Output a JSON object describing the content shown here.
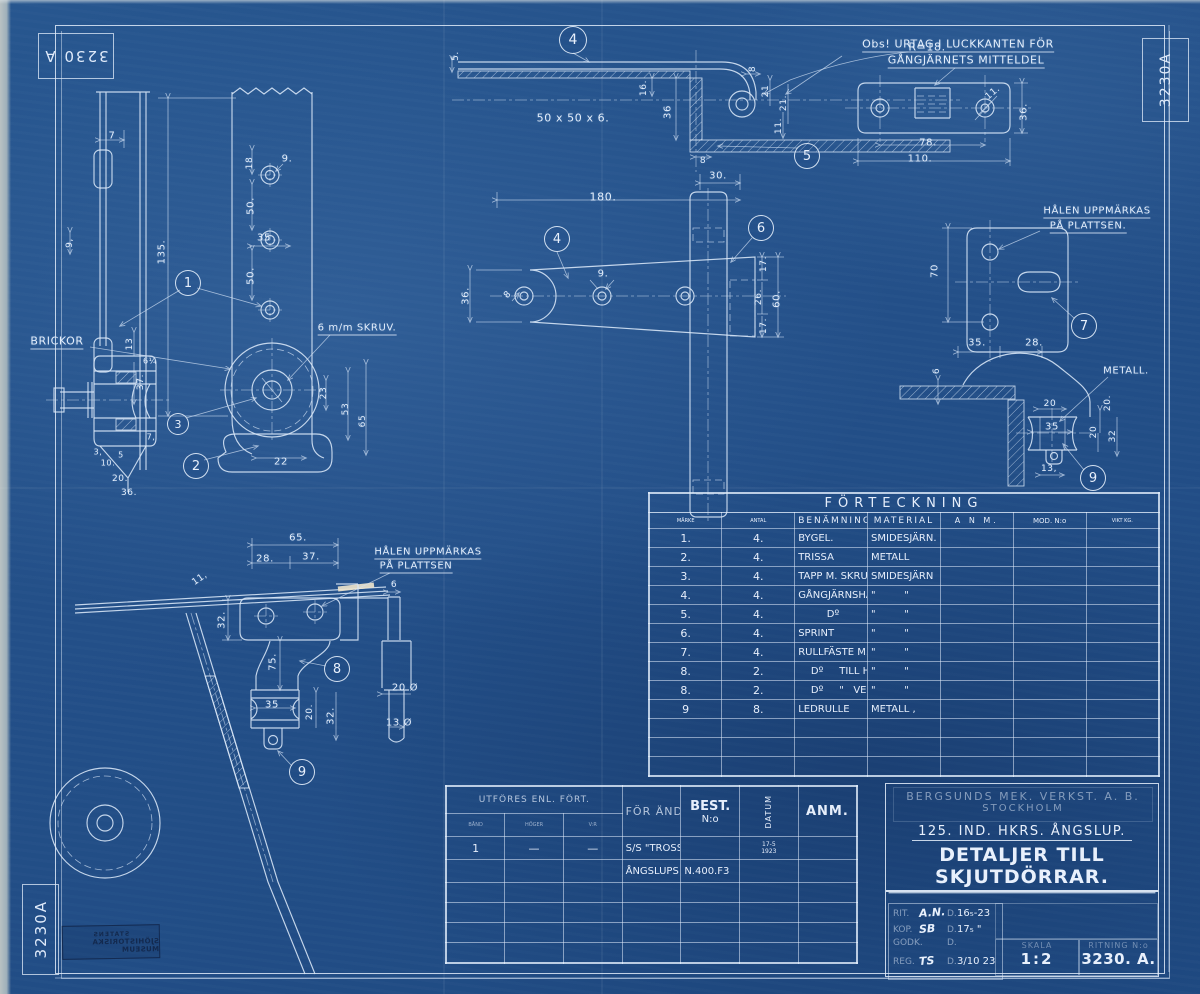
{
  "colors": {
    "background": "#234f88",
    "linework": "#dce9f8",
    "cream_highlight": "#f0e6cc",
    "museum_stamp": "#13294e"
  },
  "stamps": {
    "top_left": "3230 A",
    "top_right": "3230A",
    "bottom_left": "3230A",
    "museum_line1": "STATENS",
    "museum_line2": "SJÖHISTORISKA MUSEUM"
  },
  "parts_table": {
    "title": "FÖRTECKNING",
    "columns": [
      "MÄRKE",
      "ANTAL",
      "BENÄMNING",
      "MATERIAL",
      "A N M.",
      "MOD. N:o",
      "VIKT KG."
    ],
    "rows": [
      [
        "1.",
        "4.",
        "BYGEL.",
        "SMIDESJÄRN.",
        "",
        "",
        ""
      ],
      [
        "2.",
        "4.",
        "TRISSA",
        "METALL",
        "",
        "",
        ""
      ],
      [
        "3.",
        "4.",
        "TAPP M. SKRUV Ö. BRICKOR",
        "SMIDESJÄRN",
        "",
        "",
        ""
      ],
      [
        "4.",
        "4.",
        "GÅNGJÄRNSHALVA",
        "\"         \"",
        "",
        "",
        ""
      ],
      [
        "5.",
        "4.",
        "         Dº",
        "\"         \"",
        "",
        "",
        ""
      ],
      [
        "6.",
        "4.",
        "SPRINT",
        "\"         \"",
        "",
        "",
        ""
      ],
      [
        "7.",
        "4.",
        "RULLFÄSTE M. BRICKA Ö. SPRINT",
        "\"         \"",
        "",
        "",
        ""
      ],
      [
        "8.",
        "2.",
        "    Dº     TILL HÖGER",
        "\"         \"",
        "",
        "",
        ""
      ],
      [
        "8.",
        "2.",
        "    Dº     \"   VENSTER",
        "\"         \"",
        "",
        "",
        ""
      ],
      [
        "9",
        "8.",
        "LEDRULLE",
        "METALL ,",
        "",
        "",
        ""
      ]
    ],
    "empty_rows": 3
  },
  "order_table": {
    "header_main": "UTFÖRES ENL. FÖRT.",
    "sub_columns": [
      "BÅND",
      "HÖGER",
      "V:R"
    ],
    "col_purpose": "FÖR ÄNDAMÅL",
    "col_best_line1": "BEST.",
    "col_best_line2": "N:o",
    "col_datum": "DATUM",
    "col_anm": "ANM.",
    "rows": [
      [
        "1",
        "—",
        "—",
        "S/S \"TROSSÖ\" KARLSKRONA",
        "",
        "17-5|1923",
        ""
      ],
      [
        "",
        "",
        "",
        "ÅNGSLUPS A.B.",
        "N.400.F3",
        "",
        ""
      ]
    ],
    "empty_rows": 4
  },
  "title_block": {
    "company_line1": "BERGSUNDS MEK. VERKST. A. B.",
    "company_line2": "STOCKHOLM",
    "subtitle": "125. IND. HKRS. ÅNGSLUP.",
    "title": "DETALJER TILL SKJUTDÖRRAR.",
    "sig_rows": [
      {
        "label": "RIT.",
        "sig": "A.N.",
        "d": "D.",
        "date": "16₅-23"
      },
      {
        "label": "KOP.",
        "sig": "SB",
        "d": "D.",
        "date": "17₅ \""
      },
      {
        "label": "GODK.",
        "sig": "",
        "d": "D.",
        "date": ""
      },
      {
        "label": "REG.",
        "sig": "TS",
        "d": "D.",
        "date": "3/10 23"
      }
    ],
    "skala_label": "SKALA",
    "skala_value": "1:2",
    "ritning_label": "RITNING N:o",
    "ritning_value": "3230. A."
  },
  "annotations": [
    {
      "t": "7",
      "x": 112,
      "y": 136
    },
    {
      "t": "135.",
      "x": 162,
      "y": 252,
      "r": -90
    },
    {
      "t": "18",
      "x": 250,
      "y": 163,
      "r": -90,
      "fs": 9
    },
    {
      "t": "9.",
      "x": 287,
      "y": 159
    },
    {
      "t": "50.",
      "x": 251,
      "y": 206,
      "r": -90
    },
    {
      "t": "35",
      "x": 264,
      "y": 238
    },
    {
      "t": "50.",
      "x": 251,
      "y": 276,
      "r": -90
    },
    {
      "t": "9,",
      "x": 70,
      "y": 243,
      "r": -90,
      "fs": 9
    },
    {
      "t": "BRICKOR",
      "x": 57,
      "y": 342,
      "cls": "u",
      "fs": 11
    },
    {
      "t": "6 m/m SKRUV.",
      "x": 357,
      "y": 329,
      "cls": "u",
      "fs": 10
    },
    {
      "t": "13",
      "x": 130,
      "y": 344,
      "r": -90,
      "fs": 9
    },
    {
      "t": "6¼",
      "x": 150,
      "y": 361,
      "fs": 8
    },
    {
      "t": "37.",
      "x": 141,
      "y": 382,
      "r": -90,
      "fs": 9
    },
    {
      "t": "23",
      "x": 324,
      "y": 393,
      "r": -90,
      "fs": 9
    },
    {
      "t": "53",
      "x": 346,
      "y": 409,
      "r": -90,
      "fs": 9
    },
    {
      "t": "65",
      "x": 363,
      "y": 421,
      "r": -90,
      "fs": 9
    },
    {
      "t": "22",
      "x": 281,
      "y": 462
    },
    {
      "t": "7,",
      "x": 151,
      "y": 437,
      "fs": 8
    },
    {
      "t": "3,",
      "x": 98,
      "y": 452,
      "fs": 8
    },
    {
      "t": "10.",
      "x": 108,
      "y": 463,
      "fs": 8
    },
    {
      "t": "5",
      "x": 121,
      "y": 455,
      "fs": 8
    },
    {
      "t": "20.",
      "x": 120,
      "y": 479,
      "fs": 9
    },
    {
      "t": "36.",
      "x": 129,
      "y": 493,
      "fs": 9
    },
    {
      "t": "5.",
      "x": 456,
      "y": 56,
      "r": -90,
      "fs": 9
    },
    {
      "t": "R=18.",
      "x": 927,
      "y": 47,
      "fs": 11
    },
    {
      "t": "Obs! URTAG I LUCKKANTEN FÖR",
      "x": 958,
      "y": 45,
      "cls": "u",
      "fs": 11
    },
    {
      "t": "GÅNGJÄRNETS MITTELDEL",
      "x": 966,
      "y": 61,
      "cls": "u",
      "fs": 11
    },
    {
      "t": "16.",
      "x": 644,
      "y": 88,
      "r": -90,
      "fs": 9
    },
    {
      "t": "36",
      "x": 668,
      "y": 112,
      "r": -90
    },
    {
      "t": "50 x 50 x 6.",
      "x": 573,
      "y": 118,
      "fs": 11
    },
    {
      "t": "8",
      "x": 753,
      "y": 69,
      "r": -90,
      "fs": 9
    },
    {
      "t": "21",
      "x": 766,
      "y": 91,
      "r": -90,
      "fs": 9
    },
    {
      "t": "21.",
      "x": 784,
      "y": 103,
      "r": -90,
      "fs": 9
    },
    {
      "t": "11.",
      "x": 779,
      "y": 126,
      "r": -90,
      "fs": 9
    },
    {
      "t": "8",
      "x": 703,
      "y": 161,
      "fs": 9
    },
    {
      "t": "30.",
      "x": 718,
      "y": 176
    },
    {
      "t": "180.",
      "x": 603,
      "y": 197,
      "fs": 11
    },
    {
      "t": "36.",
      "x": 466,
      "y": 296,
      "r": -90
    },
    {
      "t": "9.",
      "x": 603,
      "y": 274
    },
    {
      "t": "8",
      "x": 508,
      "y": 295,
      "r": -45,
      "fs": 9
    },
    {
      "t": "17.",
      "x": 764,
      "y": 264,
      "r": -90,
      "fs": 9
    },
    {
      "t": "26.",
      "x": 759,
      "y": 297,
      "r": -90,
      "fs": 9
    },
    {
      "t": "60.",
      "x": 777,
      "y": 299,
      "r": -90
    },
    {
      "t": "17.",
      "x": 764,
      "y": 326,
      "r": -90,
      "fs": 9
    },
    {
      "t": "11.",
      "x": 993,
      "y": 93,
      "r": -40,
      "fs": 9
    },
    {
      "t": "36.",
      "x": 1024,
      "y": 112,
      "r": -90
    },
    {
      "t": "78.",
      "x": 928,
      "y": 143
    },
    {
      "t": "110.",
      "x": 920,
      "y": 159
    },
    {
      "t": "HÅLEN UPPMÄRKAS",
      "x": 1097,
      "y": 212,
      "cls": "u",
      "fs": 10
    },
    {
      "t": "PÅ PLATTSEN.",
      "x": 1088,
      "y": 227,
      "cls": "u",
      "fs": 10
    },
    {
      "t": "70",
      "x": 935,
      "y": 271,
      "r": -90
    },
    {
      "t": "35.",
      "x": 977,
      "y": 343
    },
    {
      "t": "28.",
      "x": 1034,
      "y": 343
    },
    {
      "t": "6",
      "x": 937,
      "y": 371,
      "r": -90,
      "fs": 9
    },
    {
      "t": "METALL.",
      "x": 1126,
      "y": 371,
      "fs": 10
    },
    {
      "t": "20",
      "x": 1050,
      "y": 404,
      "fs": 9
    },
    {
      "t": "35",
      "x": 1052,
      "y": 427
    },
    {
      "t": "20.",
      "x": 1108,
      "y": 403,
      "r": -90,
      "fs": 9
    },
    {
      "t": "20",
      "x": 1094,
      "y": 432,
      "r": -90,
      "fs": 9
    },
    {
      "t": "32",
      "x": 1113,
      "y": 436,
      "r": -90,
      "fs": 9
    },
    {
      "t": "13,",
      "x": 1049,
      "y": 469,
      "fs": 9
    },
    {
      "t": "65.",
      "x": 298,
      "y": 538
    },
    {
      "t": "28.",
      "x": 265,
      "y": 559
    },
    {
      "t": "37.",
      "x": 311,
      "y": 557
    },
    {
      "t": "HÅLEN UPPMÄRKAS",
      "x": 428,
      "y": 553,
      "cls": "u",
      "fs": 10
    },
    {
      "t": "PÅ PLATTSEN",
      "x": 416,
      "y": 567,
      "cls": "u",
      "fs": 10
    },
    {
      "t": "11,",
      "x": 200,
      "y": 579,
      "r": -35,
      "fs": 9
    },
    {
      "t": "32.",
      "x": 222,
      "y": 620,
      "r": -90
    },
    {
      "t": "6",
      "x": 394,
      "y": 585,
      "fs": 9
    },
    {
      "t": "75.",
      "x": 273,
      "y": 662,
      "r": -90
    },
    {
      "t": "20 Ø",
      "x": 405,
      "y": 688
    },
    {
      "t": "35",
      "x": 272,
      "y": 705
    },
    {
      "t": "20.",
      "x": 310,
      "y": 712,
      "r": -90,
      "fs": 9
    },
    {
      "t": "32.",
      "x": 331,
      "y": 716,
      "r": -90
    },
    {
      "t": "13 Ø",
      "x": 399,
      "y": 723
    }
  ],
  "balloons": [
    {
      "n": "1",
      "x": 188,
      "y": 283,
      "s": 24
    },
    {
      "n": "2",
      "x": 196,
      "y": 466,
      "s": 24
    },
    {
      "n": "3",
      "x": 178,
      "y": 424,
      "s": 20
    },
    {
      "n": "4",
      "x": 573,
      "y": 40,
      "s": 26
    },
    {
      "n": "4",
      "x": 557,
      "y": 239,
      "s": 24
    },
    {
      "n": "5",
      "x": 807,
      "y": 156,
      "s": 24
    },
    {
      "n": "6",
      "x": 761,
      "y": 228,
      "s": 24
    },
    {
      "n": "7",
      "x": 1084,
      "y": 326,
      "s": 24
    },
    {
      "n": "8",
      "x": 337,
      "y": 669,
      "s": 24
    },
    {
      "n": "9",
      "x": 1093,
      "y": 478,
      "s": 24
    },
    {
      "n": "9",
      "x": 302,
      "y": 772,
      "s": 24
    }
  ]
}
